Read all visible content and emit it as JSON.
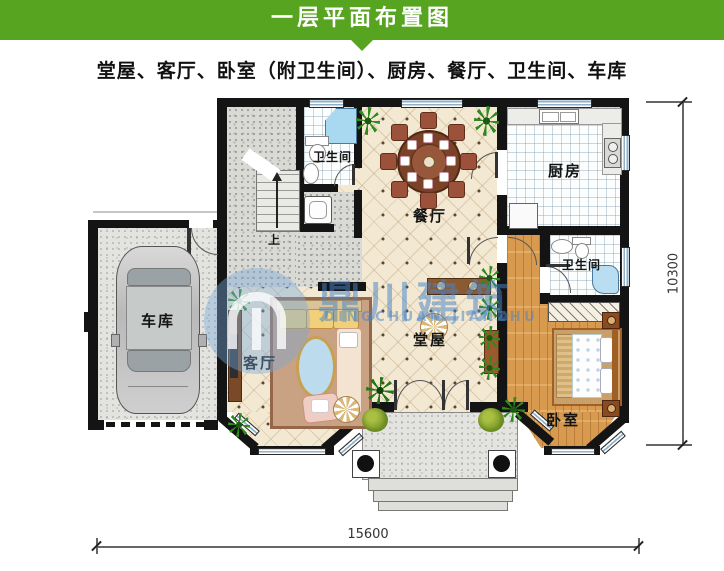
{
  "header": {
    "title": "一层平面布置图"
  },
  "subtitle": "堂屋、客厅、卧室（附卫生间）、厨房、餐厅、卫生间、车库",
  "rooms": {
    "hall": "堂屋",
    "living": "客厅",
    "bedroom": "卧室",
    "kitchen": "厨房",
    "dining": "餐厅",
    "bath1": "卫生间",
    "bath2": "卫生间",
    "garage": "车库",
    "stairs_up": "上"
  },
  "dimensions": {
    "bottom": "15600",
    "right": "10300"
  },
  "watermark": {
    "cn": "鼎川建筑",
    "en": "DINGCHUAN JIANZHU"
  },
  "colors": {
    "header_green": "#56a41f",
    "watermark_blue": "#4884c8",
    "wall": "#141414"
  }
}
